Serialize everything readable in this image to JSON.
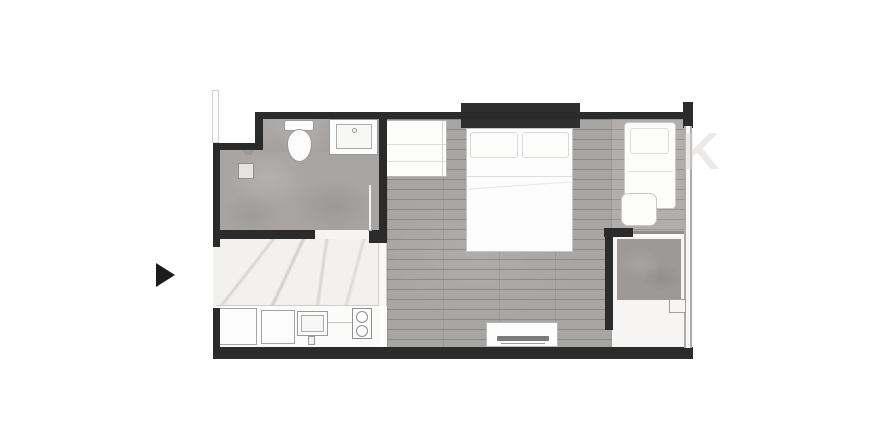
{
  "colors": {
    "wall": "#2b2b2b",
    "headboard": "#2e2e2e",
    "bathroom_floor": "#a7a4a1",
    "wood_floor": "#a8a6a3",
    "balcony_floor": "#b1aeab",
    "marble_floor": "#f2f1ee",
    "utility_floor": "#f6f5f3",
    "concrete_pad": "#9c9996",
    "fixture_fill": "#fcfcfc",
    "fixture_border": "#9a9a9a",
    "window": "#ababab",
    "arrow": "#1b1b1b",
    "watermark": "#dcdad7"
  },
  "watermark": {
    "text": "K"
  },
  "entrance": {
    "marker": "right-pointing-triangle"
  },
  "rooms": [
    {
      "name": "bathroom",
      "fixtures": [
        "toilet",
        "vanity-sink",
        "shower-head",
        "floor-drain",
        "door-leaf"
      ]
    },
    {
      "name": "kitchen-entry-hall",
      "floor": "marble",
      "fixtures": [
        "fridge-cabinet",
        "base-cabinet",
        "kitchen-sink",
        "two-burner-stove",
        "counter"
      ]
    },
    {
      "name": "bedroom-living",
      "floor": "wood",
      "fixtures": [
        "wardrobe",
        "double-bed",
        "pillows",
        "headboard",
        "tv-console",
        "tv"
      ]
    },
    {
      "name": "balcony",
      "floor": "wood",
      "fixtures": [
        "daybed",
        "ottoman-table"
      ]
    },
    {
      "name": "utility-ac-ledge",
      "fixtures": [
        "ac-pad",
        "step-notch"
      ]
    }
  ]
}
